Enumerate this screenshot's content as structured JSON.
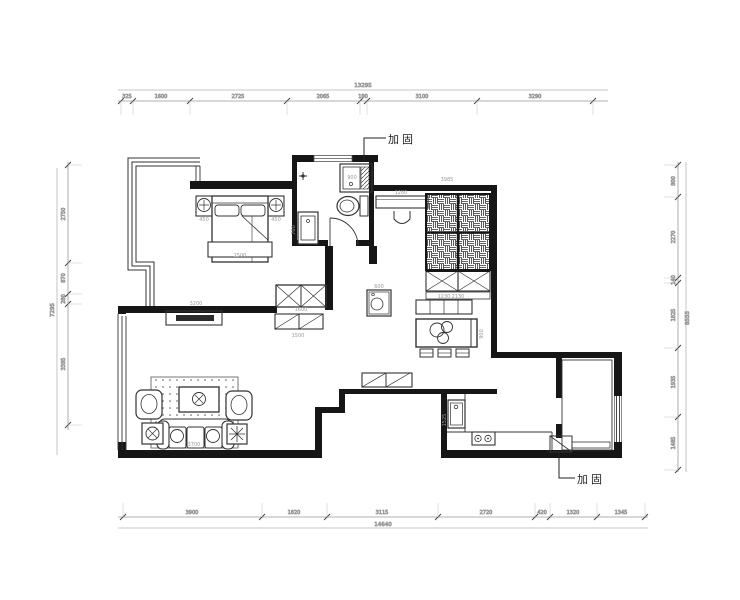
{
  "annotations": {
    "reinforcement_top": "加固",
    "reinforcement_bottom": "加固"
  },
  "dimensions": {
    "top": {
      "total": "13295",
      "segments": [
        "325",
        "1600",
        "2725",
        "2065",
        "190",
        "3100",
        "3290"
      ]
    },
    "bottom": {
      "total": "14640",
      "segments": [
        "3900",
        "1820",
        "3115",
        "2720",
        "420",
        "1320",
        "1345"
      ]
    },
    "left": {
      "total": "7295",
      "segments": [
        "2750",
        "870",
        "280",
        "3395"
      ]
    },
    "right": {
      "total": "8555",
      "segments": [
        "900",
        "2270",
        "140",
        "1825",
        "1935",
        "1485"
      ]
    }
  },
  "interior_labels": [
    {
      "t": "450",
      "x": 204,
      "y": 221,
      "r": 0
    },
    {
      "t": "450",
      "x": 276,
      "y": 221,
      "r": 0
    },
    {
      "t": "1500",
      "x": 240,
      "y": 257,
      "r": 0
    },
    {
      "t": "900",
      "x": 352,
      "y": 179,
      "r": 0
    },
    {
      "t": "700",
      "x": 295,
      "y": 230,
      "r": -90
    },
    {
      "t": "1280",
      "x": 401,
      "y": 194,
      "r": 0
    },
    {
      "t": "3985",
      "x": 447,
      "y": 181,
      "r": 0
    },
    {
      "t": "2130",
      "x": 458,
      "y": 298,
      "r": 0
    },
    {
      "t": "1600",
      "x": 301,
      "y": 311,
      "r": 0
    },
    {
      "t": "1500",
      "x": 298,
      "y": 337,
      "r": 0
    },
    {
      "t": "600",
      "x": 379,
      "y": 288,
      "r": 0
    },
    {
      "t": "1230",
      "x": 444,
      "y": 298,
      "r": 0
    },
    {
      "t": "900",
      "x": 483,
      "y": 334,
      "r": -90
    },
    {
      "t": "3200",
      "x": 196,
      "y": 305,
      "r": 0
    },
    {
      "t": "3700",
      "x": 194,
      "y": 446,
      "r": 0
    },
    {
      "t": "1525",
      "x": 446,
      "y": 420,
      "r": -90
    }
  ],
  "colors": {
    "wall": "#161616",
    "line": "#333333",
    "dim": "#9a9a9a"
  }
}
